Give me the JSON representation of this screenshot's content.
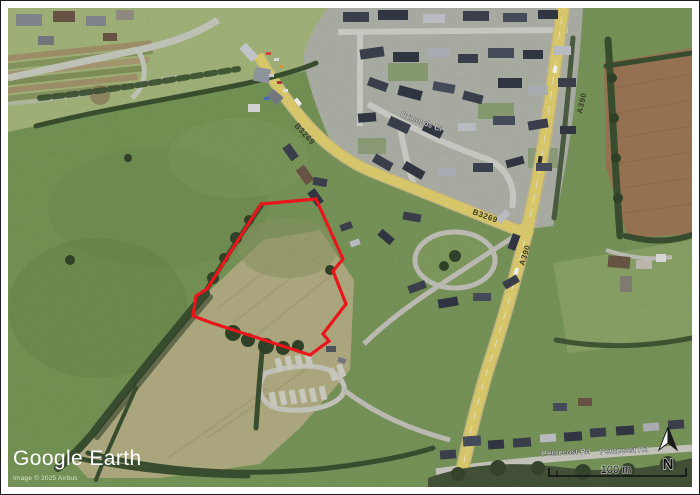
{
  "branding": {
    "logo": "Google Earth",
    "copyright": "Image © 2025 Airbus"
  },
  "map": {
    "road_labels": [
      {
        "text": "B3269"
      },
      {
        "text": "B3269"
      },
      {
        "text": "A390"
      },
      {
        "text": "A390"
      }
    ],
    "street_labels": [
      {
        "text": "Dymonds Cl"
      },
      {
        "text": "Pentecost Rd"
      },
      {
        "text": "Pentecost Rd"
      }
    ]
  },
  "overlay": {
    "scale_label": "100 m",
    "north_label": "N"
  },
  "parcel": {
    "outline_color": "#e9161c"
  }
}
